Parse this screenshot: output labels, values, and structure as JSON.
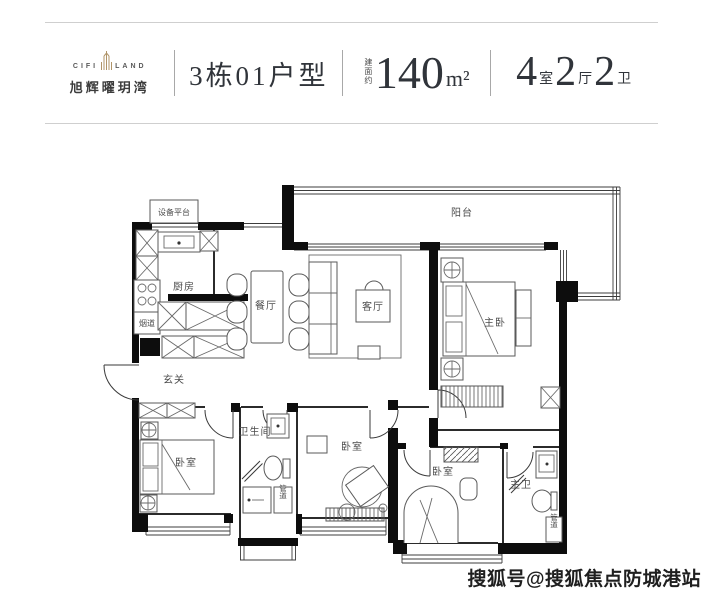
{
  "header": {
    "logo": {
      "brand_left": "CIFI",
      "brand_right": "LAND",
      "brand_cn": "旭辉曜玥湾"
    },
    "unit_title": "3栋01户型",
    "area": {
      "prefix": "建面约",
      "value": "140",
      "unit": "m²"
    },
    "layout": {
      "rooms": [
        {
          "num": "4",
          "label": "室"
        },
        {
          "num": "2",
          "label": "厅"
        },
        {
          "num": "2",
          "label": "卫"
        }
      ]
    }
  },
  "floorplan": {
    "rooms": {
      "equipment_platform": "设备平台",
      "kitchen": "厨房",
      "flue": "烟道",
      "dining": "餐厅",
      "living": "客厅",
      "balcony": "阳台",
      "master_bedroom": "主卧",
      "foyer": "玄关",
      "bedroom_left": "卧室",
      "bathroom": "卫生间",
      "bedroom_middle": "卧室",
      "bedroom_right": "卧室",
      "master_bathroom": "主卫",
      "duct_1": "管道",
      "duct_2": "管道"
    }
  },
  "watermark": "搜狐号@搜狐焦点防城港站",
  "colors": {
    "accent_gold": "#b09468",
    "text_dark": "#30343a",
    "wall_black": "#0d0d0d",
    "rule_gray": "#cfcfcf"
  }
}
